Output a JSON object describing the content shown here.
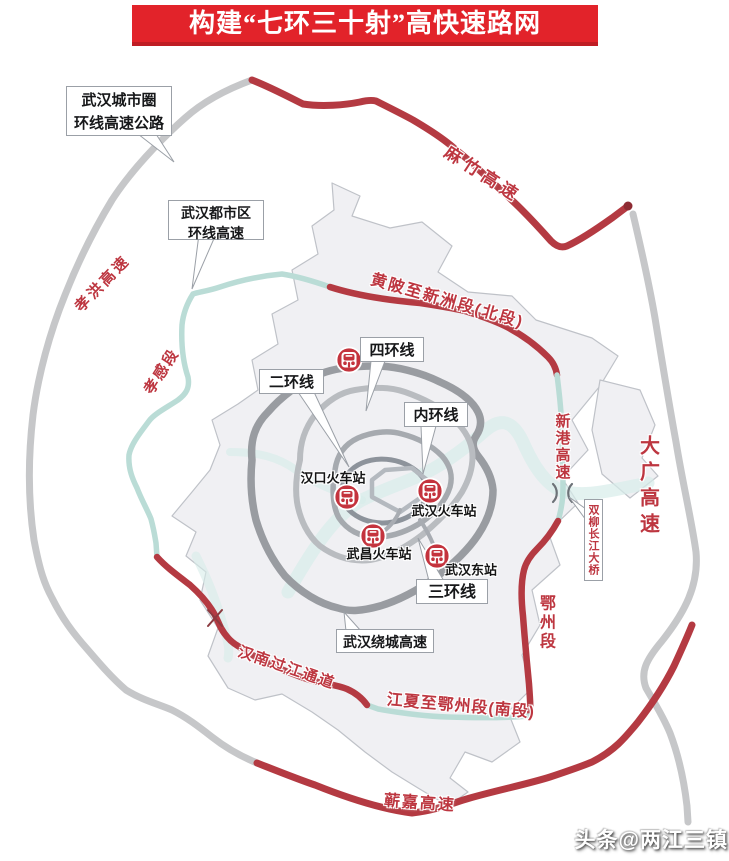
{
  "title": "构建“七环三十射”高快速路网",
  "watermark": "头条@两江三镇",
  "callouts": {
    "city_circle": {
      "line1": "武汉城市圈",
      "line2": "环线高速公路"
    },
    "metro_circle": {
      "line1": "武汉都市区",
      "line2": "环线高速"
    },
    "ring4": "四环线",
    "ring2": "二环线",
    "inner_ring": "内环线",
    "ring3": "三环线",
    "raocheng": "武汉绕城高速",
    "shuangliu_bridge": "双柳长江大桥"
  },
  "road_labels": {
    "mazhu": "麻竹高速",
    "xiaohong": "孝洪高速",
    "xiaogan_section": "孝感段",
    "north_section": "黄陂至新洲段(北段)",
    "xingang": "新港高速",
    "daguang": "大广高速",
    "ezhou_section": "鄂州段",
    "hannan_crossing": "汉南过江通道",
    "south_section": "江夏至鄂州段(南段)",
    "qijia": "蕲嘉高速"
  },
  "stations": {
    "hankou": "汉口火车站",
    "wuhan": "武汉火车站",
    "wuchang": "武昌火车站",
    "wuhan_east": "武汉东站"
  },
  "colors": {
    "banner_red": "#e2232a",
    "road_red": "#b43a42",
    "outer_ring_gray": "#c6c7c9",
    "raocheng_gray": "#999ca1",
    "teal_road": "#badcd6",
    "label_red": "#bd3640",
    "boundary_fill": "#f0f0f3"
  }
}
